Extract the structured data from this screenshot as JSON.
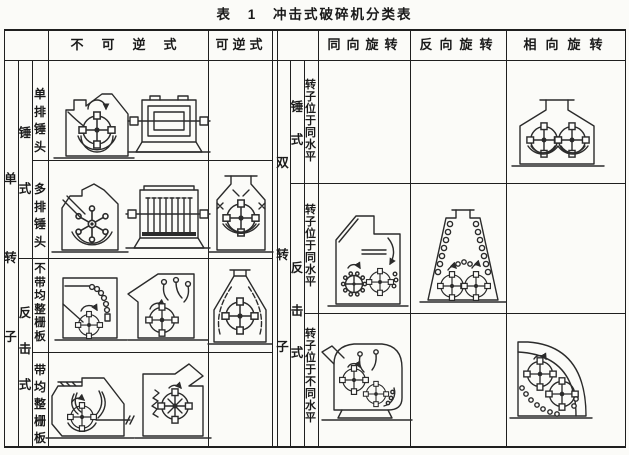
{
  "title": "表 1 冲击式破碎机分类表",
  "header": {
    "non_reversible": "不可逆式",
    "reversible": "可逆式",
    "same_direction": "同向旋转",
    "opposite_direction": "反向旋转",
    "facing_direction": "相向旋转"
  },
  "single_rotor": {
    "group": "单转子",
    "hammer": "锤式",
    "impact": "反击式",
    "rows": [
      "单排锤头",
      "多排锤头",
      "不带均整栅板",
      "带均整栅板"
    ]
  },
  "double_rotor": {
    "group": "双转子",
    "hammer": "锤式",
    "impact": "反击式",
    "rows": [
      "转子位于同水平",
      "转子位于同水平",
      "转子位于不同水平"
    ]
  },
  "diagrams": [
    "single-row-hammer-side-view",
    "single-row-hammer-axial-view",
    "multi-row-hammer-side-view",
    "multi-row-hammer-axial-view",
    "reversible-hammer-crusher",
    "impact-crusher-chain-curtain",
    "impact-crusher-hanging-plates",
    "reversible-impact-crusher",
    "impact-crusher-with-grate-side",
    "impact-crusher-with-grate-comb",
    "double-rotor-facing-same-level",
    "double-rotor-co-rotating-same-level",
    "double-rotor-counter-rotating-same-level",
    "double-rotor-co-rotating-diff-level",
    "double-rotor-facing-diff-level"
  ],
  "colors": {
    "ink": "#1a1a1a",
    "line": "#2b2b2b",
    "paper": "#fbfbf8"
  }
}
